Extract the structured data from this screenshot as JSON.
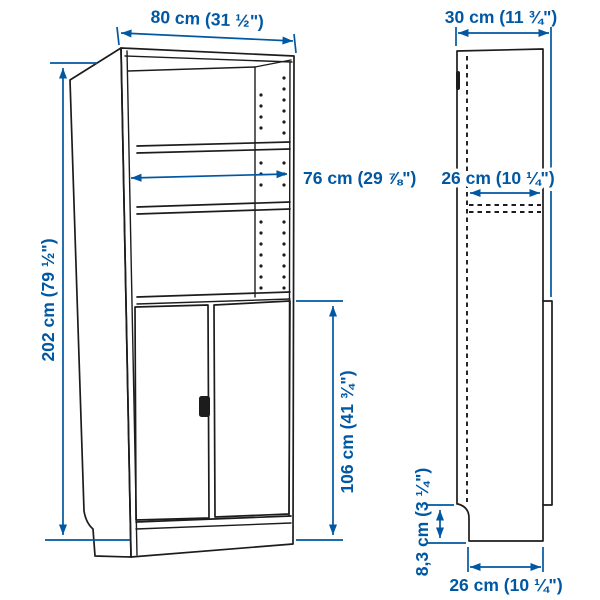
{
  "diagram": {
    "type": "furniture-dimension-drawing",
    "colors": {
      "dimension_blue": "#0058a3",
      "line_black": "#1c1c1c",
      "background": "#ffffff"
    },
    "front_view": {
      "dimensions": {
        "overall_width": "80 cm (31 ½\")",
        "overall_height": "202 cm (79 ½\")",
        "interior_width": "76 cm (29 ⅞\")",
        "door_height": "106 cm (41 ¾\")"
      }
    },
    "side_view": {
      "dimensions": {
        "overall_depth": "30 cm (11 ¾\")",
        "interior_depth": "26 cm (10 ¼\")",
        "plinth_height": "8,3 cm (3 ¼\")",
        "base_depth": "26 cm (10 ¼\")"
      }
    }
  }
}
